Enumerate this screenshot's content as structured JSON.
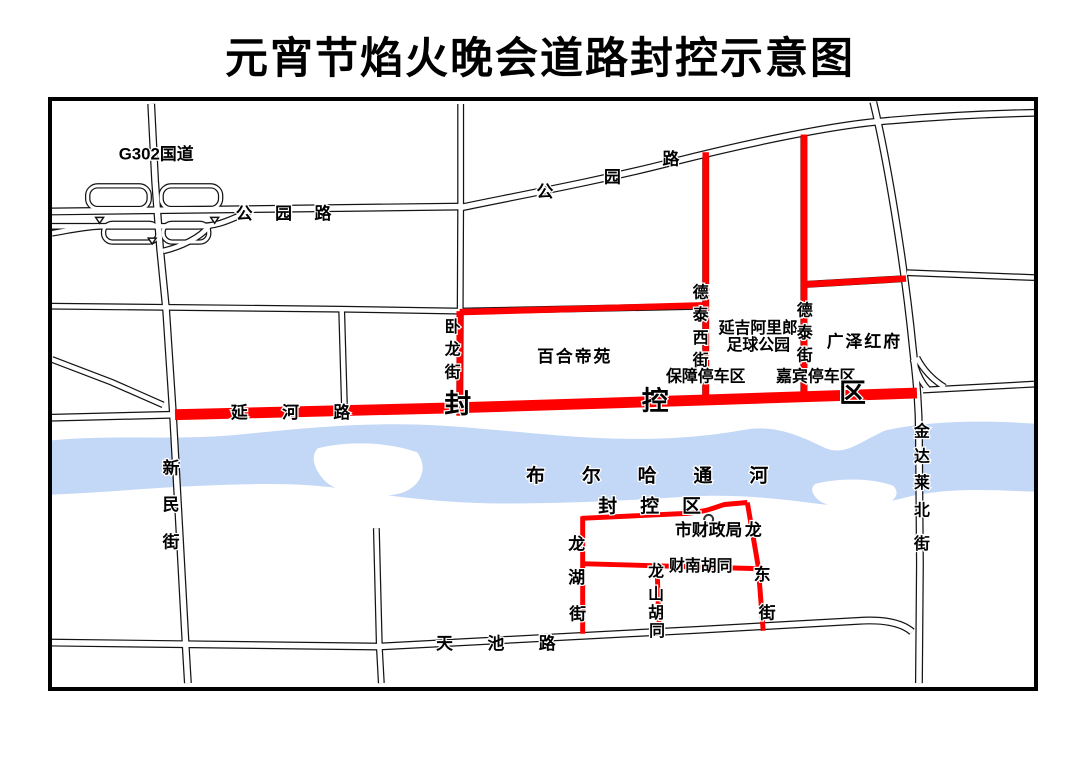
{
  "title": "元宵节焰火晚会道路封控示意图",
  "colors": {
    "closure_red": "#ff0000",
    "river_blue": "#c3d7f6",
    "road_outline": "#141414"
  },
  "map": {
    "labels": {
      "g302": "G302国道",
      "park_road": "公 园 路",
      "park_road_diag": [
        "公",
        "园",
        "路"
      ],
      "wolong": [
        "卧",
        "龙",
        "街"
      ],
      "baihe": "百合帝苑",
      "detaixi": [
        "德",
        "泰",
        "西",
        "街"
      ],
      "yanji_line1": "延吉阿里郎",
      "yanji_line2": "足球公园",
      "detai": [
        "德",
        "泰",
        "街"
      ],
      "guangze": "广泽红府",
      "baozhang": "保障停车区",
      "jiabin": "嘉宾停车区",
      "yanhe": "延 河 路",
      "fengkong": [
        "封",
        "控",
        "区"
      ],
      "xinmin": [
        "新",
        "民",
        "街"
      ],
      "river": "布 尔 哈 通 河",
      "fengkong_south": "封 控 区",
      "caizhengju": "市财政局",
      "longhu": [
        "龙",
        "湖",
        "街"
      ],
      "longdong": [
        "龙",
        "东",
        "街"
      ],
      "longshan": [
        "龙",
        "山",
        "胡",
        "同"
      ],
      "cainan": "财南胡同",
      "tianchi": "天 池 路",
      "jindalai": [
        "金",
        "达",
        "莱",
        "北",
        "街"
      ]
    }
  }
}
